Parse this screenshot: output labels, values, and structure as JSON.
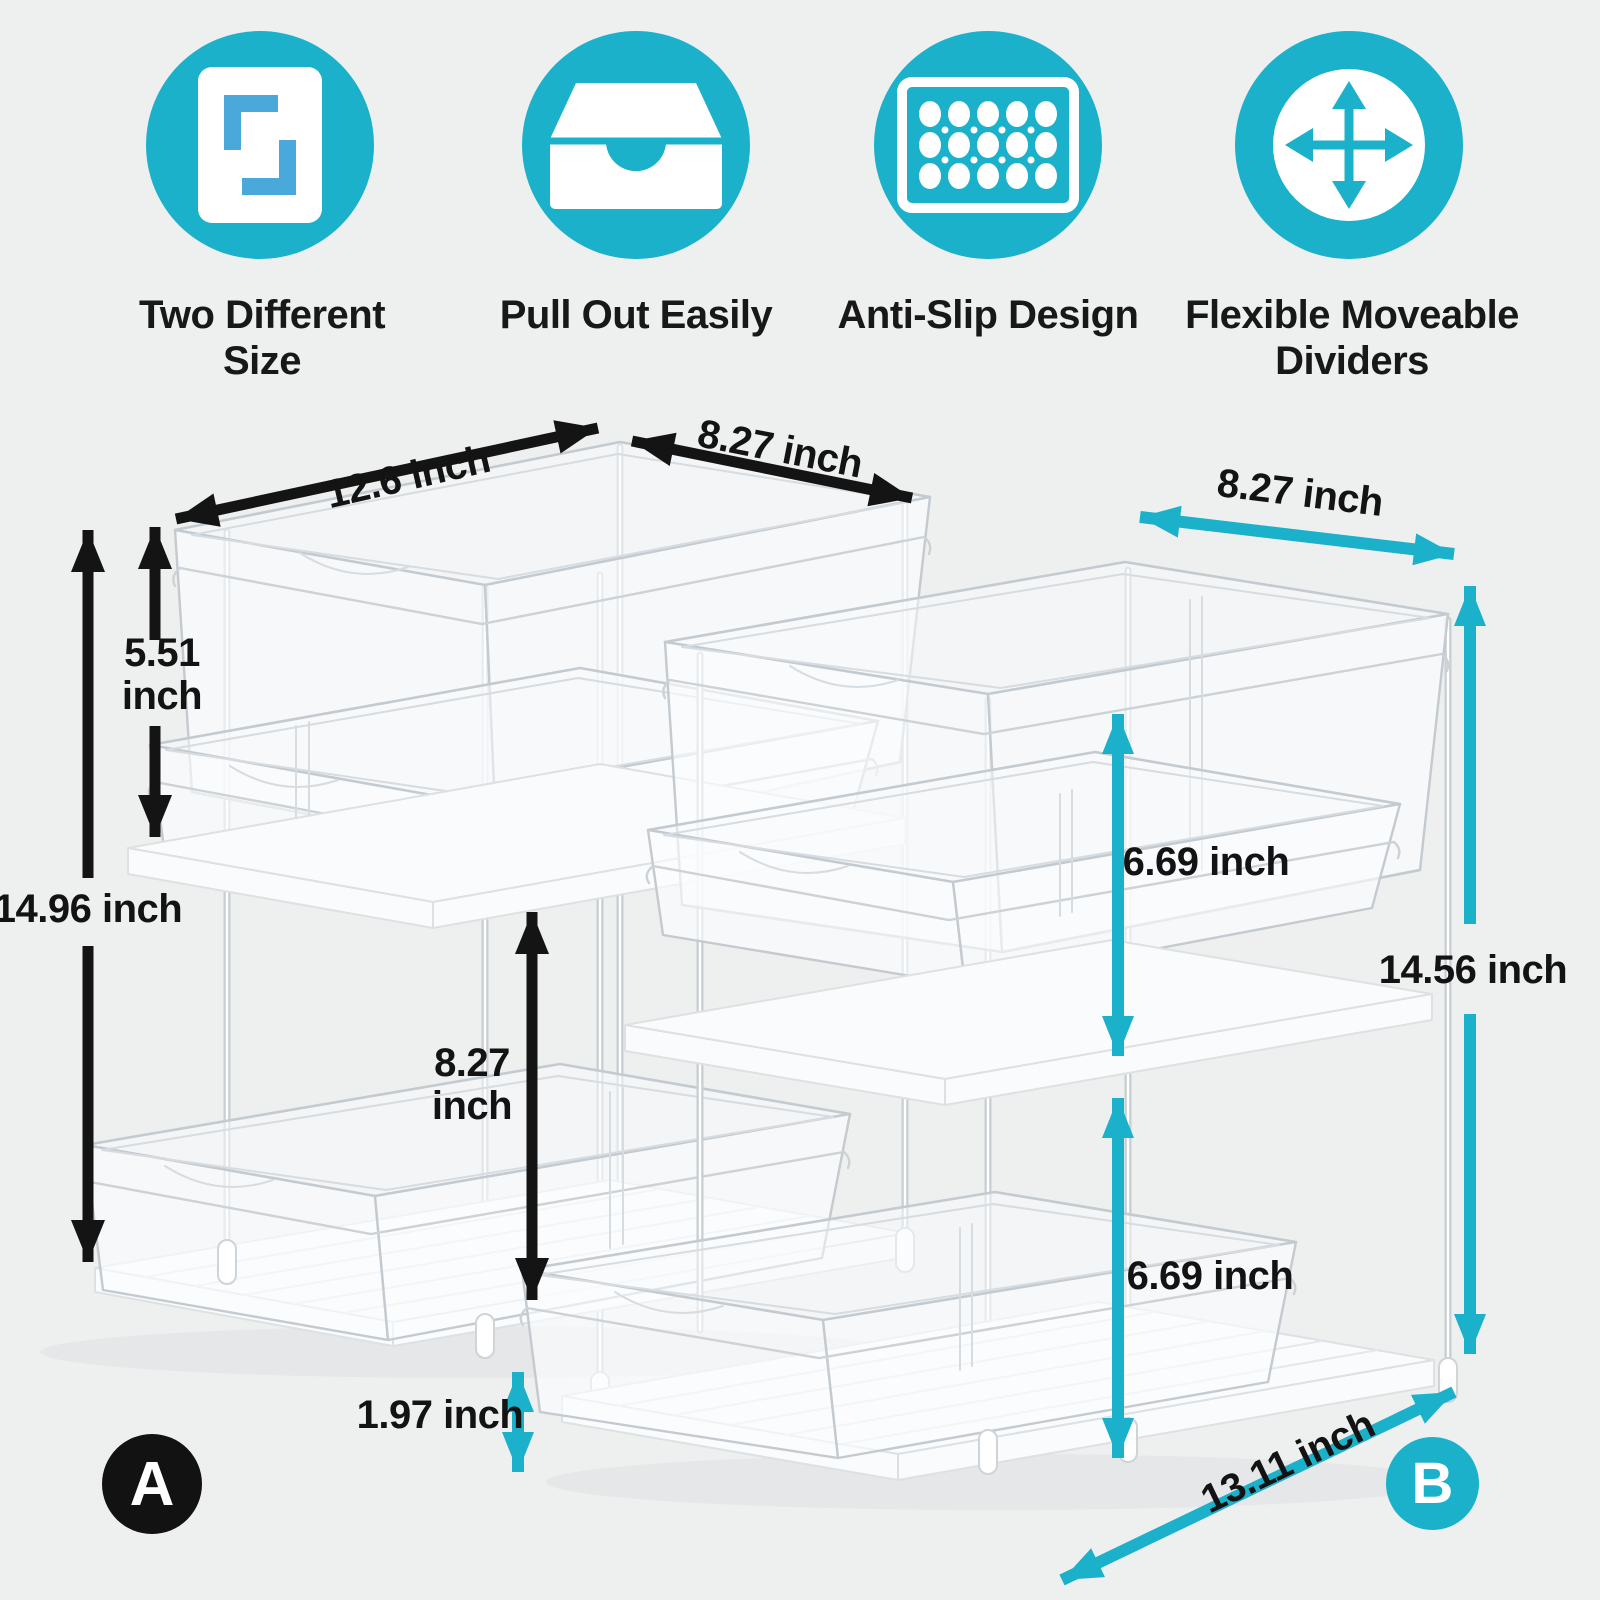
{
  "colors": {
    "accent_teal": "#1bb1ca",
    "icon_blue": "#4aa8db",
    "arrow_black": "#141414",
    "background": "#eef0f0",
    "badge_a_bg": "#121212"
  },
  "features": [
    {
      "id": "two-size",
      "label": "Two Different Size"
    },
    {
      "id": "pull-out",
      "label": "Pull Out Easily"
    },
    {
      "id": "anti-slip",
      "label": "Anti-Slip Design"
    },
    {
      "id": "move-dividers",
      "label": "Flexible Moveable Dividers"
    }
  ],
  "units": {
    "a": {
      "badge": "A",
      "arrow_color": "#141414",
      "dims": {
        "length": "12.6 inch",
        "depth": "8.27 inch",
        "top_tier_height": "5.51 inch",
        "total_height": "14.96 inch",
        "bottom_tier_height": "8.27 inch",
        "tray_height": "1.97 inch"
      }
    },
    "b": {
      "badge": "B",
      "arrow_color": "#1bb1ca",
      "dims": {
        "depth": "8.27 inch",
        "top_tier_height": "6.69 inch",
        "total_height": "14.56 inch",
        "bottom_tier_height": "6.69 inch",
        "length": "13.11 inch"
      }
    }
  }
}
